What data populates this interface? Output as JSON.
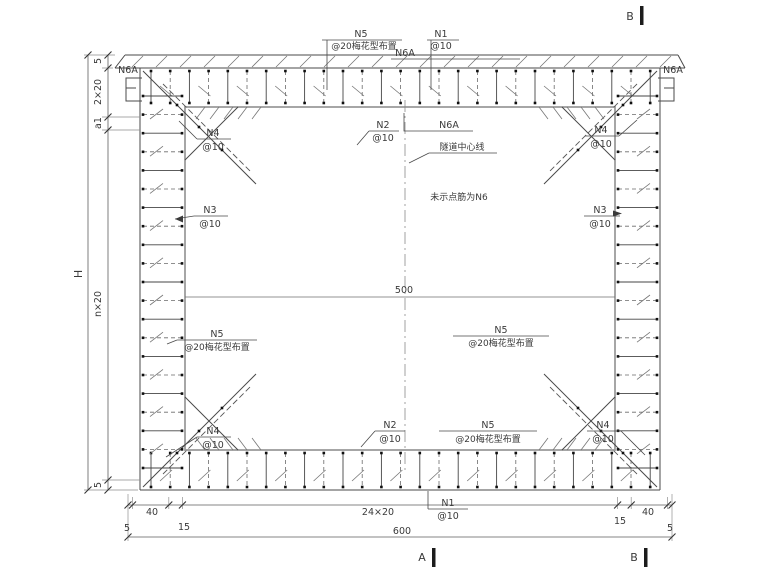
{
  "drawing": {
    "labels": {
      "n1": {
        "name": "N1",
        "spacing": "@10"
      },
      "n2": {
        "name": "N2",
        "spacing": "@10"
      },
      "n3": {
        "name": "N3",
        "spacing": "@10"
      },
      "n4": {
        "name": "N4",
        "spacing": "@10"
      },
      "n5": {
        "name": "N5",
        "spacing": "@20梅花型布置"
      },
      "n6a": {
        "name": "N6A"
      },
      "centerline": "隧道中心线",
      "note": "未示点筋为N6"
    },
    "dimensions": {
      "overall_width": "600",
      "overall_height": "H",
      "inner_width": "500",
      "bottom_chain": [
        "5",
        "40",
        "15",
        "24×20",
        "15",
        "40",
        "5"
      ],
      "left_chain": [
        "5",
        "2×20",
        "a1",
        "n×20",
        "5"
      ]
    },
    "sections": {
      "a": "A",
      "b": "B"
    },
    "colors": {
      "line": "#4a4a4a",
      "text": "#3a3a3a",
      "background": "#ffffff"
    }
  }
}
